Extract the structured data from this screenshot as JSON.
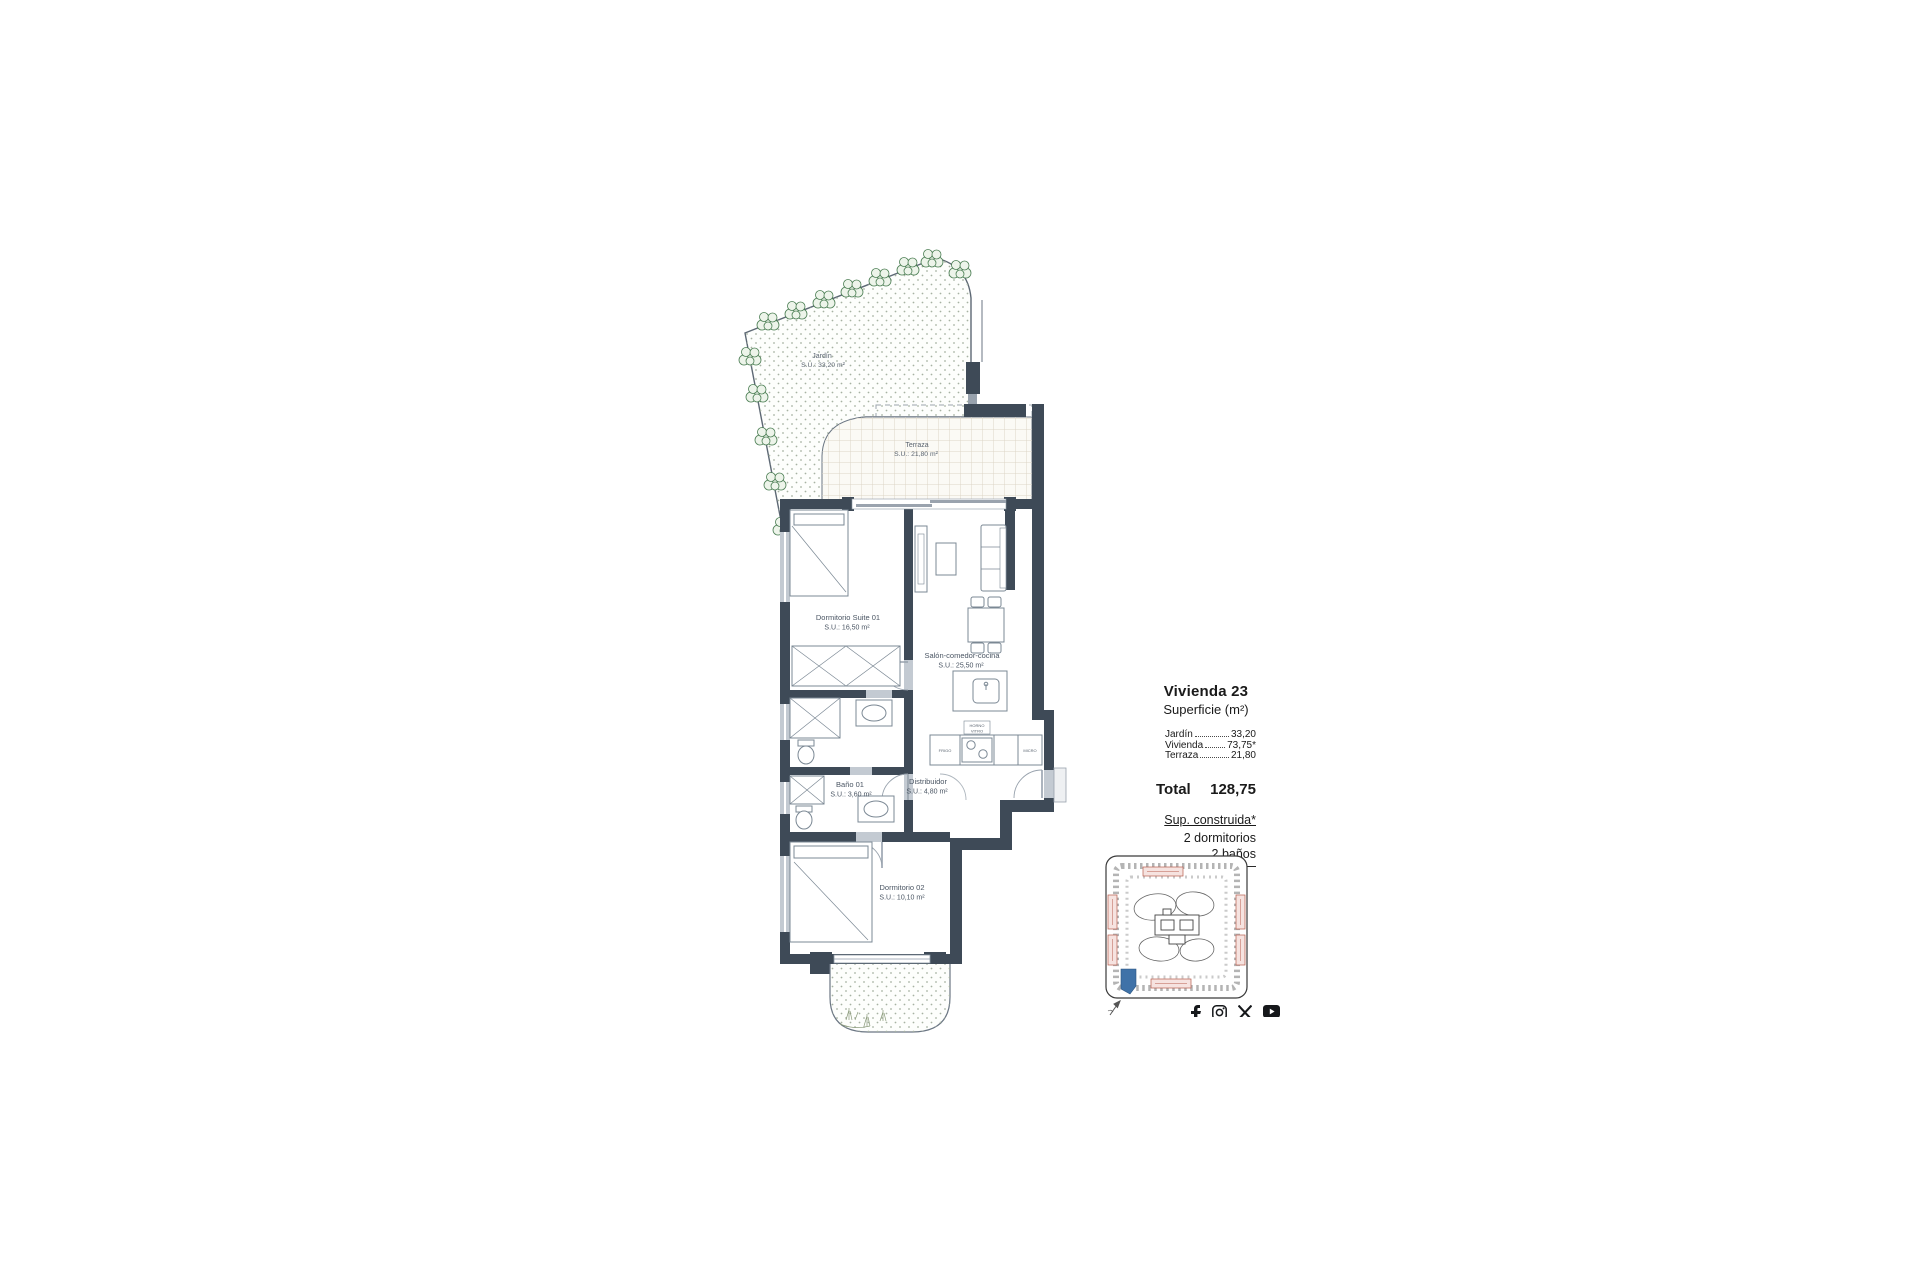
{
  "plan": {
    "rooms": {
      "jardin": {
        "name": "Jardín",
        "area": "S.U.: 33,20 m²"
      },
      "terraza": {
        "name": "Terraza",
        "area": "S.U.: 21,80 m²"
      },
      "suite": {
        "name": "Dormitorio Suite 01",
        "area": "S.U.: 16,50 m²"
      },
      "salon": {
        "name": "Salón-comedor-cocina",
        "area": "S.U.: 25,50 m²"
      },
      "bano1": {
        "name": "Baño 01",
        "area": "S.U.: 3,60 m²"
      },
      "distribuidor": {
        "name": "Distribuidor",
        "area": "S.U.: 4,80 m²"
      },
      "dorm2": {
        "name": "Dormitorio 02",
        "area": "S.U.: 10,10 m²"
      }
    },
    "appliances": {
      "fridge": "FRIGO",
      "oven": "HORNO",
      "hob": "VITRO",
      "micro": "MICRO"
    }
  },
  "info_panel": {
    "title": "Vivienda 23",
    "subtitle": "Superficie (m²)",
    "rows": [
      {
        "label": "Jardín",
        "value": "33,20"
      },
      {
        "label": "Vivienda",
        "value": "73,75*"
      },
      {
        "label": "Terraza",
        "value": "21,80"
      }
    ],
    "total_label": "Total",
    "total_value": "128,75",
    "footnote": "Sup. construida*",
    "bedrooms": "2 dormitorios",
    "bathrooms": "2 baños"
  },
  "site_plan": {
    "highlight_color": "#3f72a8",
    "label_box_color": "#b85c4e"
  },
  "colors": {
    "wall": "#3e4a57",
    "window": "#c3cad2",
    "line": "#7b8894",
    "grid": "#ddd5c6",
    "dot": "#a7b2a2",
    "tree": "#4a7d52"
  },
  "social": {
    "icons": [
      "facebook",
      "instagram",
      "x",
      "youtube"
    ]
  }
}
